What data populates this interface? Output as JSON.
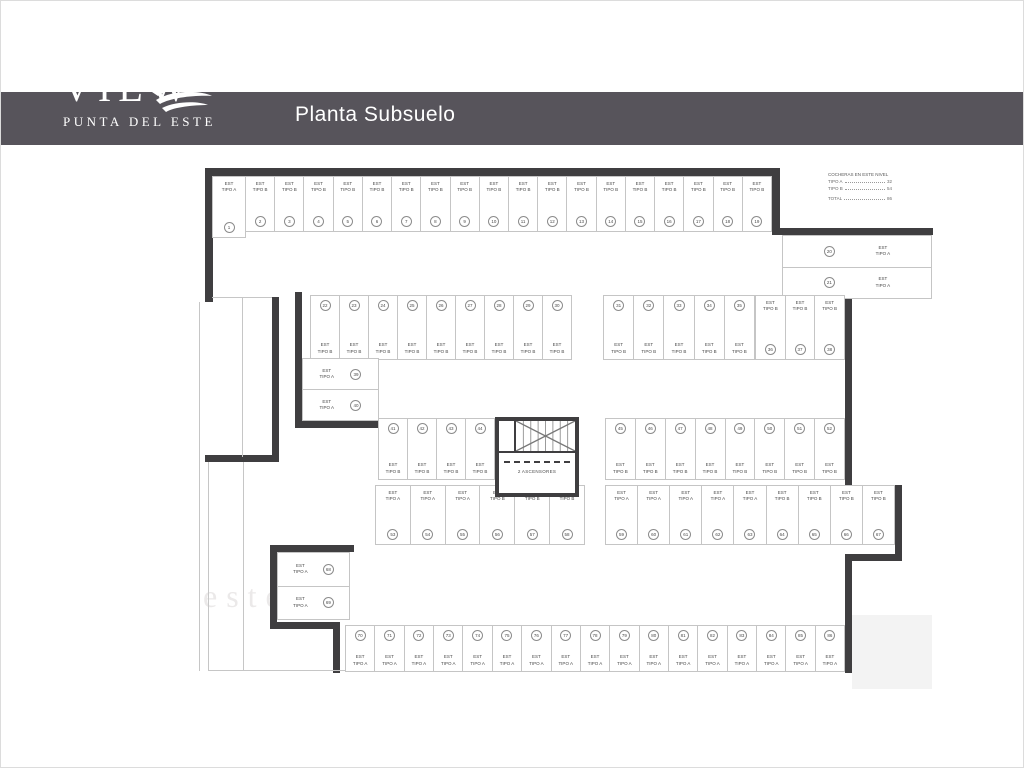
{
  "header": {
    "brand": "VIEW",
    "brand_sub": "PUNTA DEL ESTE",
    "title": "Planta Subsuelo"
  },
  "legend": {
    "title": "COCHERAS EN ESTE NIVEL",
    "rows": [
      {
        "label": "TIPO A",
        "value": "32"
      },
      {
        "label": "TIPO B",
        "value": "54"
      },
      {
        "label": "TOTAL",
        "value": "86"
      }
    ]
  },
  "plan": {
    "elevator_label": "2 ASCENSORES",
    "tipo_labels": {
      "A": "EST\nTIPO A",
      "B": "EST\nTIPO B"
    },
    "watermarks": [
      "a",
      "este"
    ],
    "groups": [
      {
        "name": "top-row-first",
        "stalls": [
          {
            "num": 1,
            "tipo": "A"
          }
        ]
      },
      {
        "name": "top-row",
        "stalls": [
          {
            "num": 2,
            "tipo": "B"
          },
          {
            "num": 3,
            "tipo": "B"
          },
          {
            "num": 4,
            "tipo": "B"
          },
          {
            "num": 5,
            "tipo": "B"
          },
          {
            "num": 6,
            "tipo": "B"
          },
          {
            "num": 7,
            "tipo": "B"
          },
          {
            "num": 8,
            "tipo": "B"
          },
          {
            "num": 9,
            "tipo": "B"
          },
          {
            "num": 10,
            "tipo": "B"
          },
          {
            "num": 11,
            "tipo": "B"
          },
          {
            "num": 12,
            "tipo": "B"
          },
          {
            "num": 13,
            "tipo": "B"
          },
          {
            "num": 14,
            "tipo": "B"
          },
          {
            "num": 15,
            "tipo": "B"
          },
          {
            "num": 16,
            "tipo": "B"
          },
          {
            "num": 17,
            "tipo": "B"
          },
          {
            "num": 18,
            "tipo": "B"
          },
          {
            "num": 19,
            "tipo": "B"
          }
        ]
      },
      {
        "name": "right-side-pair",
        "stalls": [
          {
            "num": 20,
            "tipo": "A"
          },
          {
            "num": 21,
            "tipo": "A"
          }
        ]
      },
      {
        "name": "row2-left",
        "stalls": [
          {
            "num": 22,
            "tipo": "B"
          },
          {
            "num": 23,
            "tipo": "B"
          },
          {
            "num": 24,
            "tipo": "B"
          },
          {
            "num": 25,
            "tipo": "B"
          },
          {
            "num": 26,
            "tipo": "B"
          },
          {
            "num": 27,
            "tipo": "B"
          },
          {
            "num": 28,
            "tipo": "B"
          },
          {
            "num": 29,
            "tipo": "B"
          },
          {
            "num": 30,
            "tipo": "B"
          }
        ]
      },
      {
        "name": "row2-right-a",
        "stalls": [
          {
            "num": 31,
            "tipo": "B"
          },
          {
            "num": 32,
            "tipo": "B"
          },
          {
            "num": 33,
            "tipo": "B"
          },
          {
            "num": 34,
            "tipo": "B"
          },
          {
            "num": 35,
            "tipo": "B"
          }
        ]
      },
      {
        "name": "row2-right-b",
        "stalls": [
          {
            "num": 36,
            "tipo": "B"
          },
          {
            "num": 37,
            "tipo": "B"
          },
          {
            "num": 38,
            "tipo": "B"
          }
        ]
      },
      {
        "name": "mid-left-pair",
        "stalls": [
          {
            "num": 39,
            "tipo": "A"
          },
          {
            "num": 40,
            "tipo": "A"
          }
        ]
      },
      {
        "name": "mid-row-left",
        "stalls": [
          {
            "num": 41,
            "tipo": "B"
          },
          {
            "num": 42,
            "tipo": "B"
          },
          {
            "num": 43,
            "tipo": "B"
          },
          {
            "num": 44,
            "tipo": "B"
          }
        ]
      },
      {
        "name": "mid-row-right",
        "stalls": [
          {
            "num": 45,
            "tipo": "B"
          },
          {
            "num": 46,
            "tipo": "B"
          },
          {
            "num": 47,
            "tipo": "B"
          },
          {
            "num": 48,
            "tipo": "B"
          },
          {
            "num": 49,
            "tipo": "B"
          },
          {
            "num": 50,
            "tipo": "B"
          },
          {
            "num": 51,
            "tipo": "B"
          },
          {
            "num": 52,
            "tipo": "B"
          }
        ]
      },
      {
        "name": "low-row-left",
        "stalls": [
          {
            "num": 53,
            "tipo": "A"
          },
          {
            "num": 54,
            "tipo": "A"
          },
          {
            "num": 55,
            "tipo": "A"
          },
          {
            "num": 56,
            "tipo": "B"
          },
          {
            "num": 57,
            "tipo": "B"
          },
          {
            "num": 58,
            "tipo": "B"
          }
        ]
      },
      {
        "name": "low-row-right",
        "stalls": [
          {
            "num": 59,
            "tipo": "A"
          },
          {
            "num": 60,
            "tipo": "A"
          },
          {
            "num": 61,
            "tipo": "A"
          },
          {
            "num": 62,
            "tipo": "A"
          },
          {
            "num": 63,
            "tipo": "A"
          },
          {
            "num": 64,
            "tipo": "B"
          },
          {
            "num": 65,
            "tipo": "B"
          },
          {
            "num": 66,
            "tipo": "B"
          },
          {
            "num": 67,
            "tipo": "B"
          }
        ]
      },
      {
        "name": "bottom-left-pair",
        "stalls": [
          {
            "num": 68,
            "tipo": "A"
          },
          {
            "num": 69,
            "tipo": "A"
          }
        ]
      },
      {
        "name": "bottom-row",
        "stalls": [
          {
            "num": 70,
            "tipo": "A"
          },
          {
            "num": 71,
            "tipo": "A"
          },
          {
            "num": 72,
            "tipo": "A"
          },
          {
            "num": 73,
            "tipo": "A"
          },
          {
            "num": 74,
            "tipo": "A"
          },
          {
            "num": 75,
            "tipo": "A"
          },
          {
            "num": 76,
            "tipo": "A"
          },
          {
            "num": 77,
            "tipo": "A"
          },
          {
            "num": 78,
            "tipo": "A"
          },
          {
            "num": 79,
            "tipo": "A"
          },
          {
            "num": 80,
            "tipo": "A"
          },
          {
            "num": 81,
            "tipo": "A"
          },
          {
            "num": 82,
            "tipo": "A"
          },
          {
            "num": 83,
            "tipo": "A"
          },
          {
            "num": 84,
            "tipo": "A"
          },
          {
            "num": 85,
            "tipo": "A"
          },
          {
            "num": 86,
            "tipo": "A"
          }
        ]
      }
    ]
  }
}
